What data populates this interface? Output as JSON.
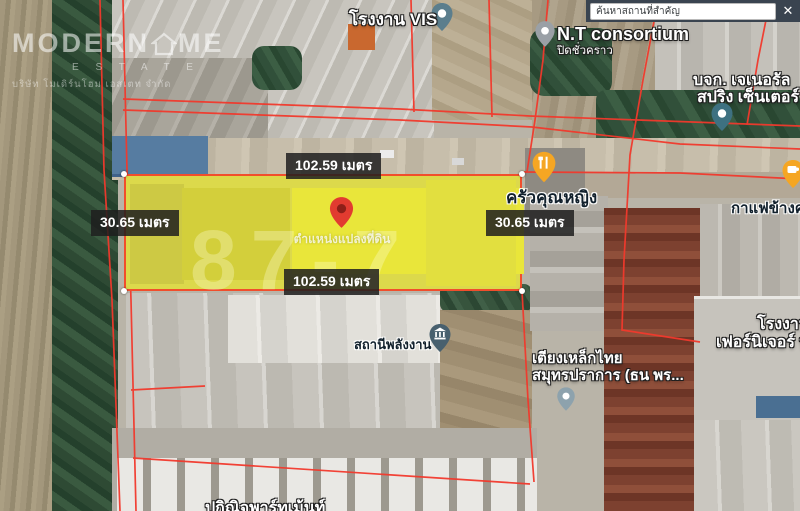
{
  "search": {
    "query": "ค้นหาสถานที่สำคัญ",
    "close_label": "✕"
  },
  "watermark": {
    "brand_left": "MODERN",
    "brand_right": "ME",
    "estate": "E S T A T E",
    "company": "บริษัท โมเดิร์นโฮม เอสเตท จำกัด"
  },
  "plot": {
    "top_width": "102.59 เมตร",
    "bottom_width": "102.59 เมตร",
    "left_depth": "30.65 เมตร",
    "right_depth": "30.65 เมตร",
    "pin_caption": "ตำแหน่งแปลงที่ดิน",
    "watermark_digits": "87-7",
    "fill_color": "#e9e63a",
    "border_color": "#f14e2c"
  },
  "places": {
    "vis_factory": {
      "label": "โรงงาน VIS"
    },
    "nt_consortium": {
      "label": "N.T consortium",
      "status": "ปิดชั่วคราว"
    },
    "general_spring": {
      "label_line1": "บจก. เจเนอรัล",
      "label_line2": "สปริง เซ็นเตอร์"
    },
    "khrua_khunying": {
      "label": "ครัวคุณหญิง"
    },
    "coffee_shop": {
      "label": "กาแฟข้างคล"
    },
    "energy_station": {
      "label": "สถานีพลังงาน"
    },
    "thai_steel_bed": {
      "label_line1": "เตียงเหล็กไทย",
      "label_line2": "สมุทรปราการ (ธน พร..."
    },
    "furniture_factory": {
      "label_line1": "โรงงาน",
      "label_line2": "เฟอร์นิเจอร์ บ"
    },
    "apartment": {
      "label": "ปกิณิจพาร์ทเม้นท์"
    }
  },
  "colors": {
    "cadastral_line": "#f2392c",
    "badge_bg": "#1e1e1e",
    "pin_red": "#e23b30",
    "pin_orange": "#f5a623",
    "pin_slate": "#5b7e8d",
    "pin_teal": "#3e7181",
    "pin_gray": "#9aa0a6"
  }
}
